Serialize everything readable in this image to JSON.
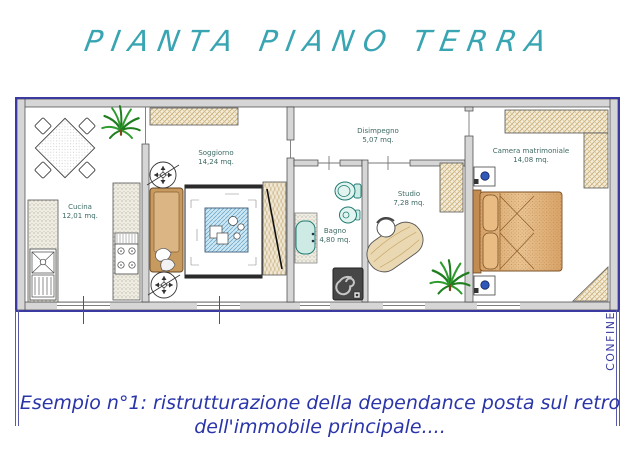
{
  "title": "PIANTA PIANO TERRA",
  "plan": {
    "rooms": {
      "cucina": {
        "name": "Cucina",
        "area": "12,01 mq."
      },
      "soggiorno": {
        "name": "Soggiorno",
        "area": "14,24 mq."
      },
      "disimpegno": {
        "name": "Disimpegno",
        "area": "5,07 mq."
      },
      "bagno": {
        "name": "Bagno",
        "area": "4,80 mq."
      },
      "studio": {
        "name": "Studio",
        "area": "7,28 mq."
      },
      "camera": {
        "name": "Camera matrimoniale",
        "area": "14,08 mq."
      }
    },
    "boundary_label": "CONFINE"
  },
  "caption": {
    "line1": "Esempio n°1: ristrutturazione della dependance posta sul retro",
    "line2": "dell'immobile principale...."
  },
  "colors": {
    "title_text": "#39a5b2",
    "caption_text": "#2a35aa",
    "boundary_text": "#3a3aa0",
    "plan_outline": "#3a3aa0",
    "wall_fill": "#d6d6d6",
    "room_label_text": "#3d6a63",
    "fixture_teal": "#1f7a72",
    "wood_tan": "#c79a5f",
    "table_blue": "#6fa8cc"
  }
}
